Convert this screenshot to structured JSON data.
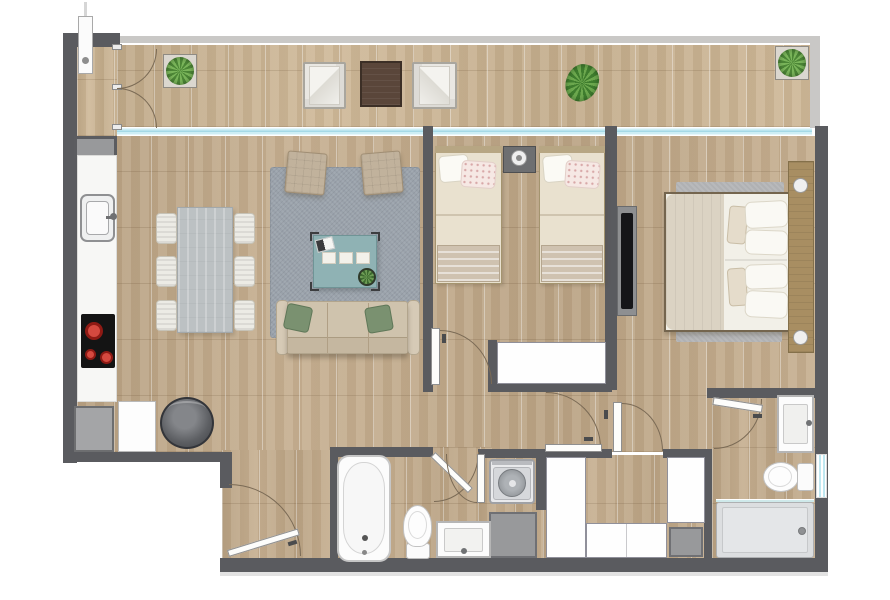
{
  "document": {
    "type": "architectural-floor-plan",
    "description": "Top-down rendered floor plan of a two-bedroom apartment with terrace",
    "visible_text": "",
    "counts": {
      "bedrooms": 2,
      "bathrooms": 2,
      "terraces": 1
    }
  },
  "palette": {
    "wall": "#5a5b5f",
    "terrace_parapet": "#c9c8c6",
    "wood_floor": "#c3ab8b",
    "terrace_wood": "#ccb593",
    "glass_wall": "#cdeef5",
    "rug": "#9aa2ab",
    "sofa": "#cfc3ad",
    "accent_cushion_green": "#7a9170",
    "coffee_table_teal": "#8fb2b4",
    "dining_table": "#bcc1c3",
    "bed_linen_cream": "#e9e1cf",
    "blanket": "#cfc2b0",
    "headboard_wood": "#a88e62",
    "closet_white": "#fefefe",
    "appliance_gray": "#98999b",
    "cooktop_black": "#141414",
    "burner_red": "#c3271f",
    "plant_green": "#4c8636",
    "shower_tray": "#dcdee0",
    "tv_black": "#151518",
    "side_table_brown": "#5a463a"
  },
  "rooms": [
    {
      "name": "terrace",
      "furniture": [
        "water-heater",
        "french-doors",
        "potted-succulent",
        "lounge-chair",
        "side-table",
        "lounge-chair",
        "grass-plant",
        "potted-succulent"
      ]
    },
    {
      "name": "kitchen-living-dining",
      "furniture": [
        "kitchen-counter",
        "kitchen-sink",
        "cooktop",
        "refrigerator",
        "cabinet",
        "storage-drum",
        "dining-table",
        "dining-chairs-x6",
        "area-rug",
        "armchair-x2",
        "coffee-table",
        "sofa"
      ]
    },
    {
      "name": "bedroom-2",
      "furniture": [
        "single-bed-x2",
        "nightstand",
        "lamp",
        "wardrobe",
        "door"
      ]
    },
    {
      "name": "master-bedroom",
      "furniture": [
        "double-bed",
        "headboard-with-nightstands",
        "lamp-x2",
        "rug-x2",
        "tv-panel",
        "door",
        "walk-in-closets"
      ]
    },
    {
      "name": "bathroom-1",
      "furniture": [
        "bathtub",
        "toilet",
        "vanity-sink",
        "door"
      ]
    },
    {
      "name": "laundry-nook",
      "furniture": [
        "top-load-washer",
        "utility-base",
        "door"
      ]
    },
    {
      "name": "master-bathroom",
      "furniture": [
        "vanity-sink",
        "toilet",
        "shower",
        "window",
        "door"
      ]
    },
    {
      "name": "entry-hall",
      "furniture": [
        "entrance-door"
      ]
    }
  ]
}
